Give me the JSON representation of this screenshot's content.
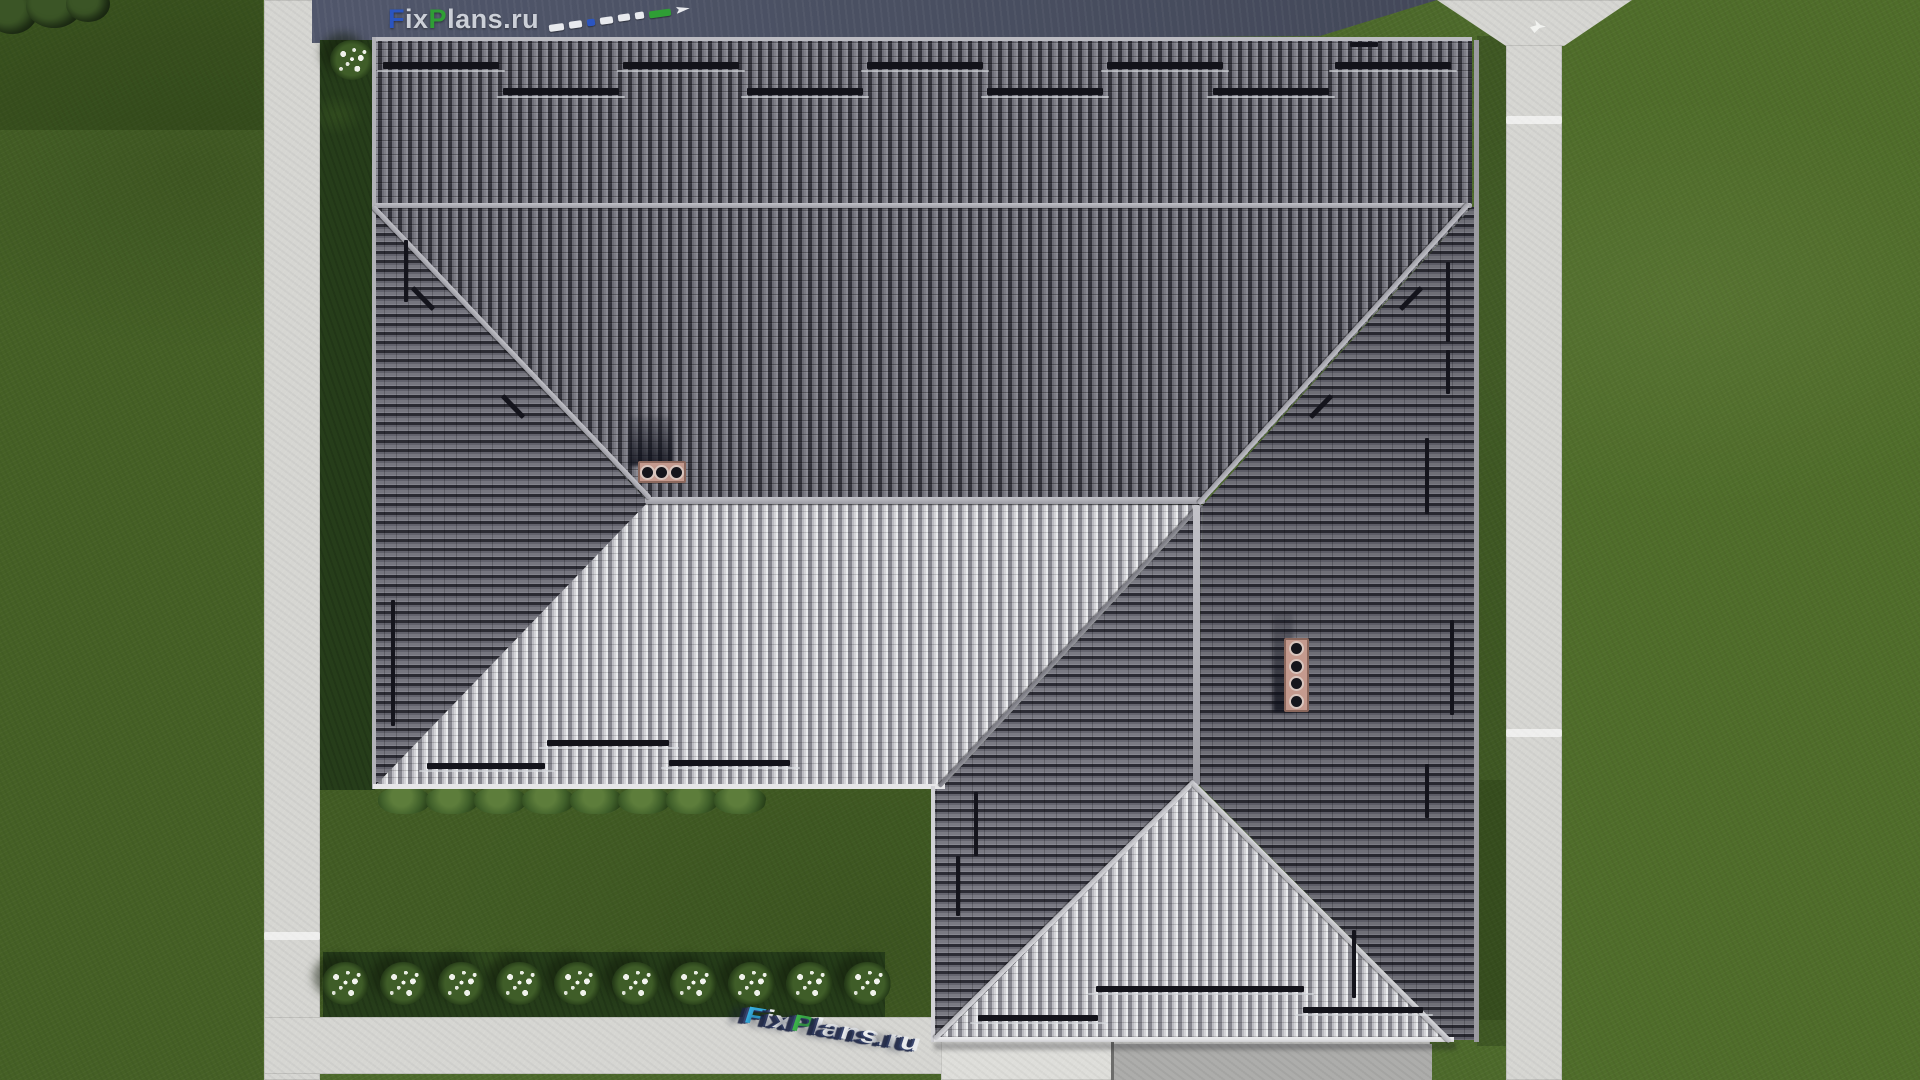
{
  "scene": {
    "title": "Aerial top-down 3D render of a house with gray tiled hip roof, lawn and concrete walkways",
    "site_brand": "FixPlans.ru",
    "chimney_count": 2,
    "flower_bush_count": 10
  },
  "watermark_top": {
    "text": "FixPlans.ru",
    "letters": [
      {
        "ch": "F",
        "color": "#2b55c0"
      },
      {
        "ch": "i",
        "color": "#ccd0d8"
      },
      {
        "ch": "x",
        "color": "#ccd0d8"
      },
      {
        "ch": "P",
        "color": "#2f9e35"
      },
      {
        "ch": "l",
        "color": "#ccd0d8"
      },
      {
        "ch": "a",
        "color": "#ccd0d8"
      },
      {
        "ch": "n",
        "color": "#ccd0d8"
      },
      {
        "ch": "s",
        "color": "#ccd0d8"
      },
      {
        "ch": ".",
        "color": "#ccd0d8"
      },
      {
        "ch": "r",
        "color": "#ccd0d8"
      },
      {
        "ch": "u",
        "color": "#ccd0d8"
      }
    ],
    "tail_dashes": [
      {
        "w": 15,
        "color": "#e8eaee"
      },
      {
        "w": 13,
        "color": "#e8eaee"
      },
      {
        "w": 8,
        "color": "#2b55c0"
      },
      {
        "w": 13,
        "color": "#e8eaee"
      },
      {
        "w": 12,
        "color": "#e8eaee"
      },
      {
        "w": 9,
        "color": "#e8eaee"
      },
      {
        "w": 22,
        "color": "#2f9e35"
      },
      {
        "w": 14,
        "color": "#e8eaee",
        "tip": true
      }
    ]
  },
  "watermark_bottom": {
    "text": "FixPlans.ru",
    "letters": [
      {
        "ch": "F",
        "color": "#38b2e4"
      },
      {
        "ch": "i",
        "color": "#eef0f2"
      },
      {
        "ch": "x",
        "color": "#eef0f2"
      },
      {
        "ch": "P",
        "color": "#3db54a"
      },
      {
        "ch": "l",
        "color": "#eef0f2"
      },
      {
        "ch": "a",
        "color": "#eef0f2"
      },
      {
        "ch": "n",
        "color": "#eef0f2"
      },
      {
        "ch": "s",
        "color": "#eef0f2"
      },
      {
        "ch": ".",
        "color": "#e8eaec"
      },
      {
        "ch": "r",
        "color": "#e8eaec"
      },
      {
        "ch": "u",
        "color": "#e8eaec"
      }
    ]
  },
  "theme": {
    "grass": "#4d6a2b",
    "bed": "#263d1a",
    "path": "#d6d6d2",
    "road": "#4a5062",
    "roofDarkRib": "#7d7d86",
    "roofDarkGap": "#34343c",
    "roofLightRib": "#d4d4d8",
    "roofLightGap": "#86868e",
    "snow": "#13131a",
    "brick": "#c49a8e"
  }
}
